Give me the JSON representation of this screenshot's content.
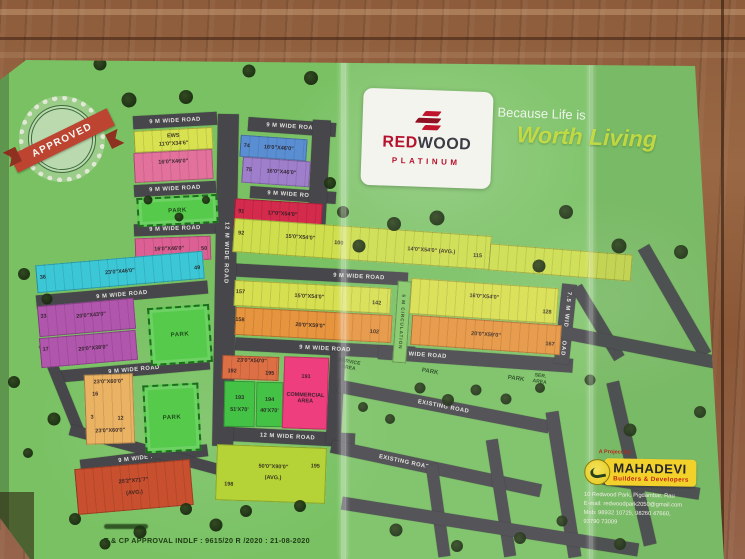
{
  "branding": {
    "logo_red": "RED",
    "logo_wood": "WOOD",
    "logo_sub": "PLATINUM",
    "tagline_1": "Because Life is",
    "tagline_2": "Worth Living"
  },
  "stamp": {
    "label": "APPROVED"
  },
  "developer": {
    "project_by": "A Project by",
    "name": "MAHADEVI",
    "subtitle": "Builders & Developers",
    "lines": [
      "10 Redwood Park, Pigdambar, Rau",
      "E-mail: redwoodpark2050@gmail.com",
      "Mob: 98932 10725, 98260 47660,",
      "93790 73009"
    ]
  },
  "approval": {
    "main": "T & CP APPROVAL  INDLF : 9615/20 R /2020  : 21-08-2020"
  },
  "labels": {
    "park": "PARK",
    "service_area": "SERVICE AREA",
    "ser_area": "SER. AREA"
  },
  "roads": {
    "r9_top_left": "9 M WIDE ROAD",
    "r9_top_center": "9 M WIDE ROAD",
    "r9_left_2": "9 M WIDE ROAD",
    "r9_center_2": "9 M WIDE ROAD",
    "r9_left_3": "9 M WIDE ROAD",
    "r9_left_4": "9 M WIDE ROAD",
    "r9_left_5": "9 M WIDE ROAD",
    "r9_left_6": "9 M WIDE ROAD",
    "r9_center_3": "9 M WIDE ROAD",
    "r9_center_4": "9 M WIDE ROAD",
    "r9_right": "9 M WIDE ROAD",
    "r12_h": "12 M WIDE ROAD",
    "r12_v": "12 M WIDE ROAD",
    "r75_v": "7.5 M WIDE ROAD",
    "circulation": "6 M CIRCULATION",
    "existing_1": "EXISTING ROAD",
    "existing_2": "EXISTING ROAD"
  },
  "plots": {
    "ews": {
      "color": "#d8e14f",
      "tag": "EWS",
      "dims": "11'0\"X34'6\""
    },
    "pink_top": {
      "color": "#e2729c",
      "dims": "16'0\"X46'0\""
    },
    "blue_74": {
      "color": "#5a8ed2",
      "n1": "74",
      "dims": "16'0\"X46'0\""
    },
    "purple_75": {
      "color": "#9f7fcb",
      "n1": "75",
      "dims": "16'0\"X46'0\""
    },
    "pink_50": {
      "color": "#dc6094",
      "dims": "16'0\"X46'0\"",
      "n2": "50"
    },
    "cyan": {
      "color": "#3cc7d6",
      "n1": "36",
      "dims": "23'0\"X46'0\"",
      "n2": "49"
    },
    "purple_33": {
      "color": "#b156ad",
      "n1": "33",
      "dims": "20'0\"X43'0\""
    },
    "purple_17": {
      "color": "#b156ad",
      "n1": "17",
      "dims": "20'0\"X38'0\""
    },
    "red_91": {
      "color": "#d42a4c",
      "n1": "91",
      "dims": "17'0\"X54'0\""
    },
    "yellow_long": {
      "color": "#cede4d",
      "n1": "92",
      "dims": "15'0\"X54'0\"",
      "n2": "100",
      "dims2": "14'0\"X54'0\" (AVG.)",
      "n3": "115"
    },
    "yellow_157": {
      "color": "#d6df50",
      "n1": "157",
      "dims": "15'0\"X54'0\"",
      "n2": "142"
    },
    "orange_158": {
      "color": "#e7943e",
      "n1": "158",
      "dims": "20'0\"X59'0\"",
      "n2": "102"
    },
    "yellow_128": {
      "color": "#d8df4e",
      "dims": "16'0\"X54'0\"",
      "n2": "128"
    },
    "orange_167": {
      "color": "#e7943e",
      "dims": "20'0\"X59'0\"",
      "n2": "167"
    },
    "light_orange": {
      "color": "#eab263",
      "dims": "23'0\"X60'0\"",
      "n1": "16",
      "n2": "3",
      "n3": "12",
      "dims2": "23'0\"X60'0\""
    },
    "red_avg": {
      "color": "#c8502f",
      "dims": "25'2\"X71'7\"",
      "sub": "(AVG.)"
    },
    "orange_192": {
      "color": "#dd6f45",
      "dims": "23'0\"X50'0\"",
      "n1": "192",
      "n2": "195"
    },
    "green_193": {
      "color": "#44c246",
      "n1": "193",
      "dims": "51'X70'"
    },
    "green_194": {
      "color": "#44c246",
      "n1": "194",
      "dims": "40'X70'"
    },
    "commercial": {
      "color": "#ee3e7e",
      "n1": "191",
      "label": "COMMERCIAL AREA"
    },
    "yg_5090": {
      "color": "#b5d336",
      "dims": "50'0\"X90'0\"",
      "sub": "(AVG.)",
      "n1": "198",
      "n2": "195"
    }
  },
  "colors": {
    "paper_green": "#79c163",
    "road_gray": "#46464b",
    "park_green": "#55ca4b",
    "stamp_red": "#c23b2e",
    "logo_red": "#b5122d",
    "mahadevi_yellow": "#f2d22a"
  }
}
